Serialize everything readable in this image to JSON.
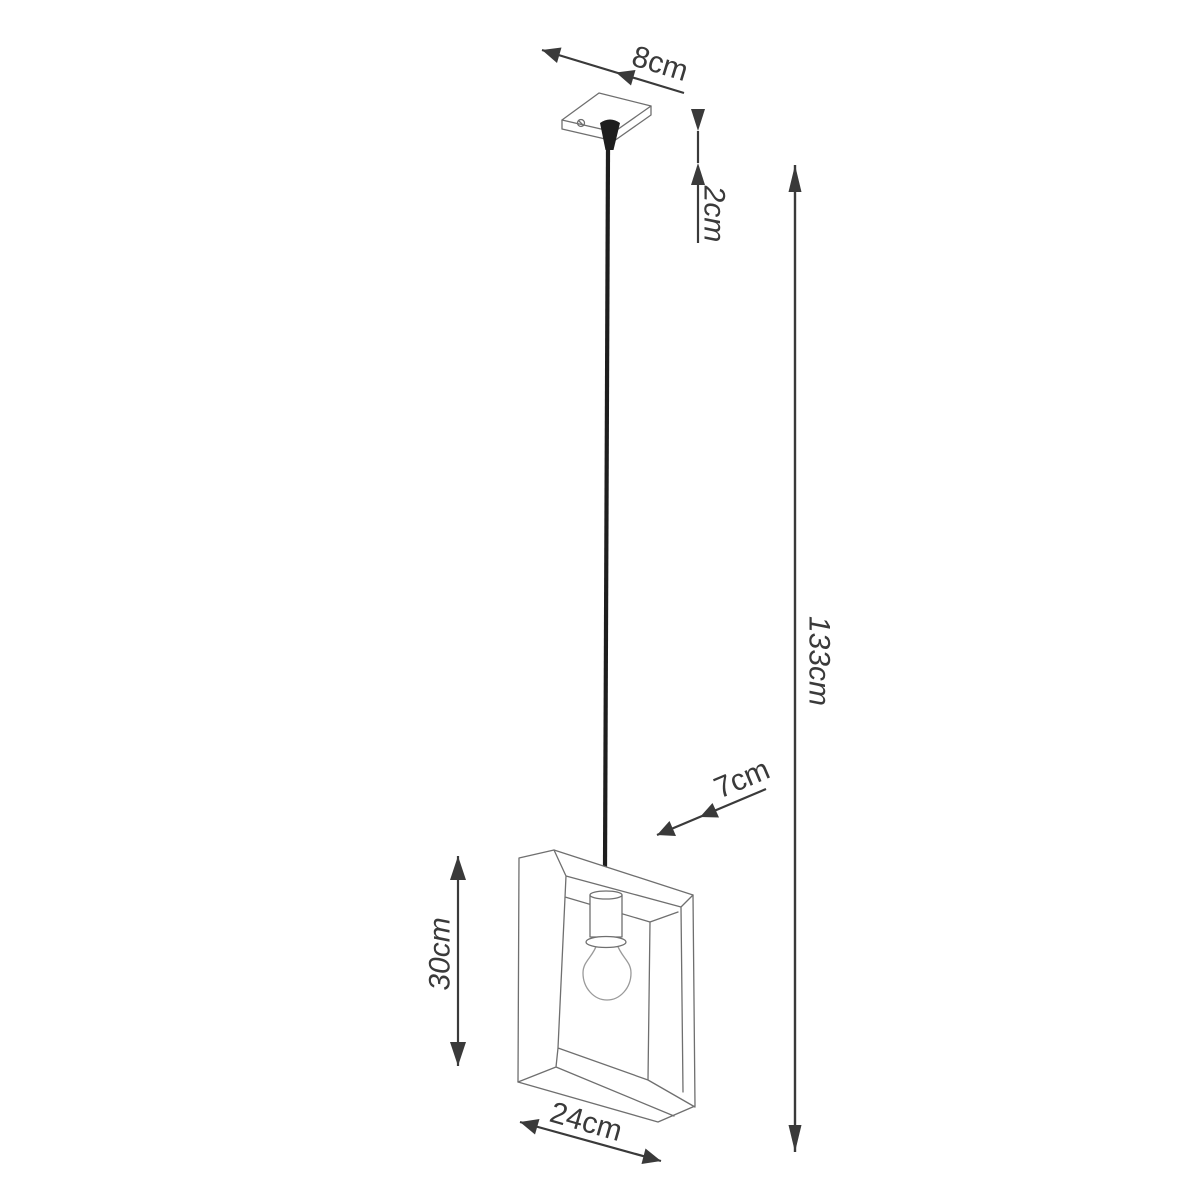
{
  "diagram": {
    "colors": {
      "background": "#ffffff",
      "dimension_line": "#3a3a3a",
      "product_outline": "#6f6f6f",
      "bulb_outline": "#9a9a9a",
      "cable": "#1e1e1e"
    },
    "dimensions": {
      "canopy_width": {
        "label": "8cm"
      },
      "canopy_height": {
        "label": "2cm"
      },
      "drop_length": {
        "label": "133cm"
      },
      "shade_depth": {
        "label": "7cm"
      },
      "shade_height": {
        "label": "30cm"
      },
      "shade_width": {
        "label": "24cm"
      }
    }
  }
}
